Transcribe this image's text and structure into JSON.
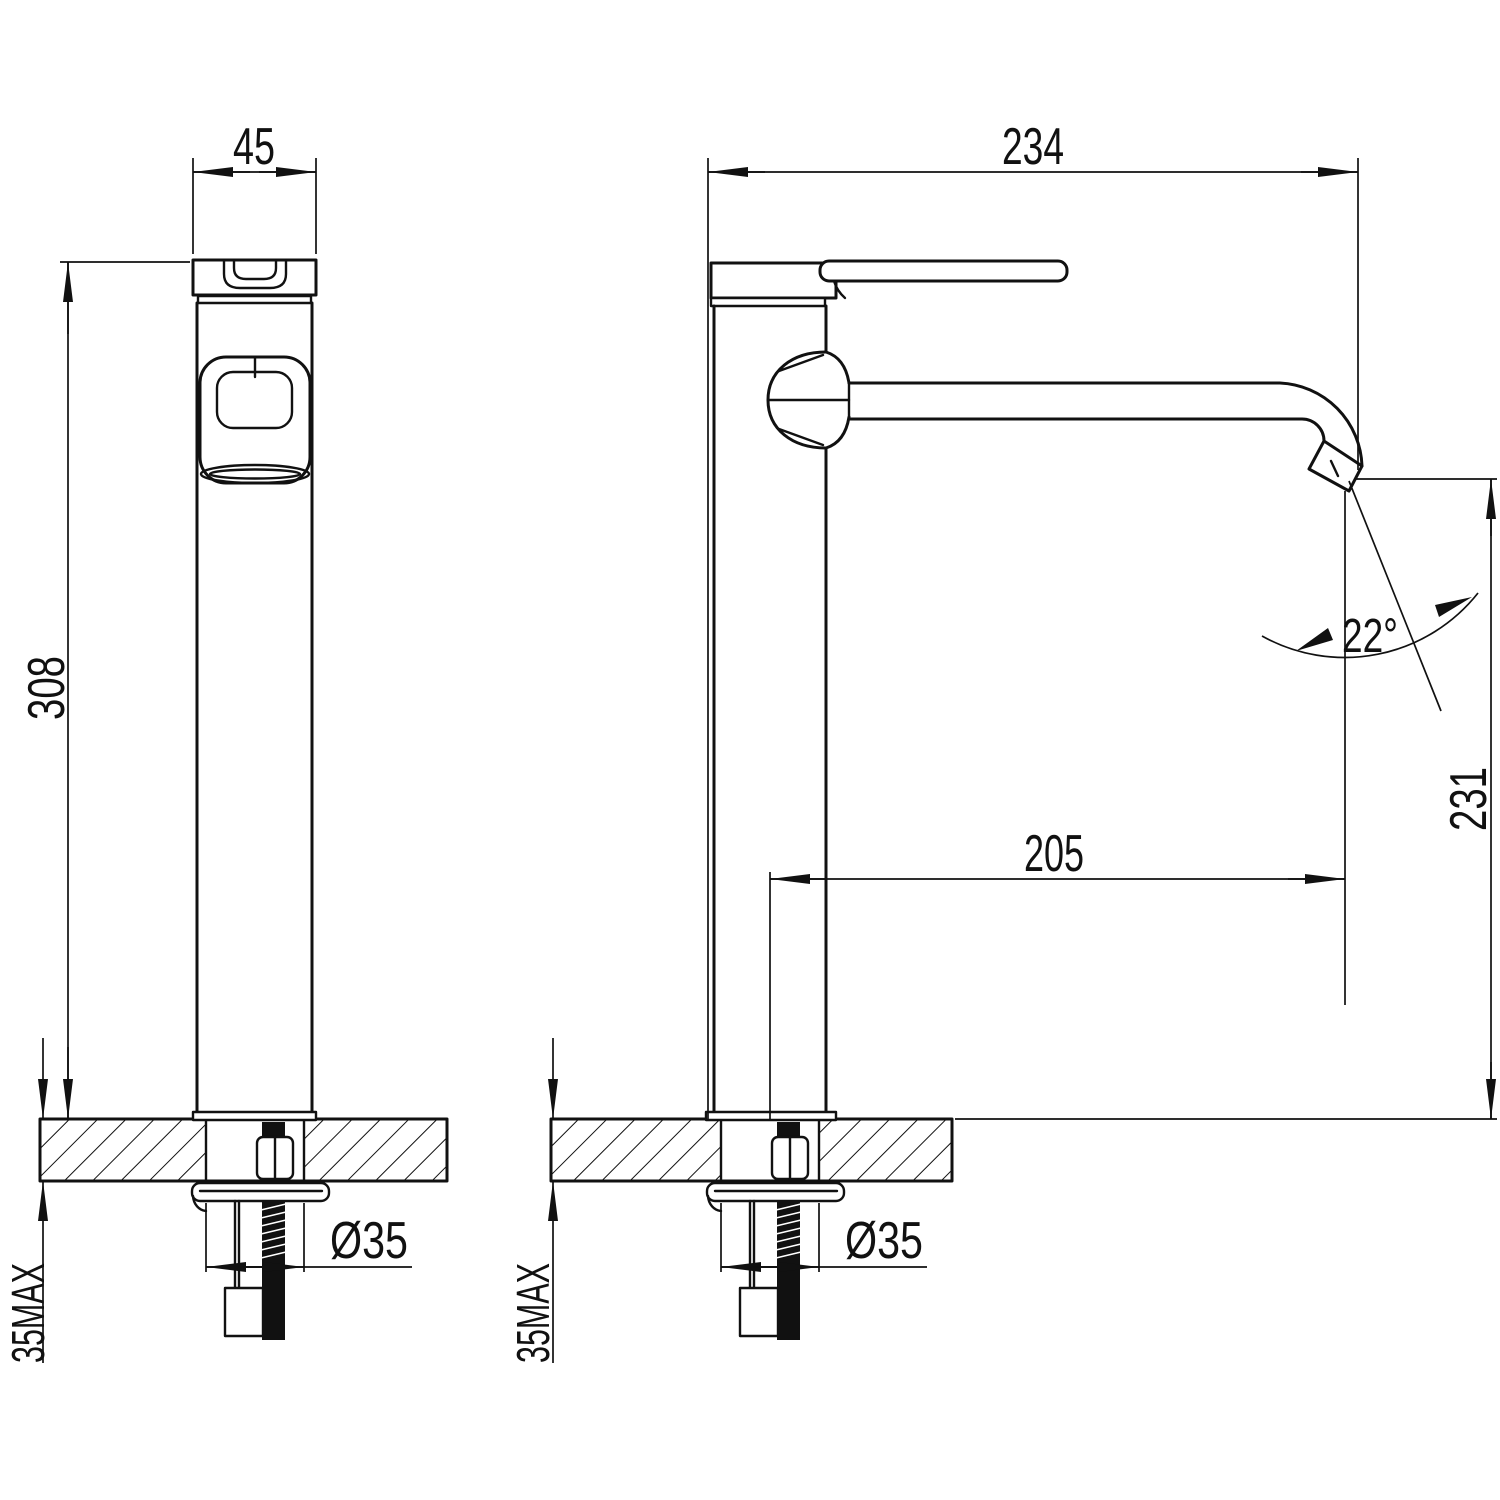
{
  "drawing": {
    "type": "technical-dimension-drawing",
    "subject": "tall-basin-mixer-faucet",
    "colors": {
      "line": "#111111",
      "background": "#ffffff"
    },
    "views": {
      "side": {
        "width_dim": "45",
        "height_dim": "308",
        "deck_thickness_dim": "35MAX",
        "hole_dia_dim": "Ø35"
      },
      "front": {
        "depth_dim": "234",
        "spout_reach_dim": "205",
        "spout_height_dim": "231",
        "spout_angle_dim": "22°",
        "deck_thickness_dim": "35MAX",
        "hole_dia_dim": "Ø35"
      }
    }
  }
}
